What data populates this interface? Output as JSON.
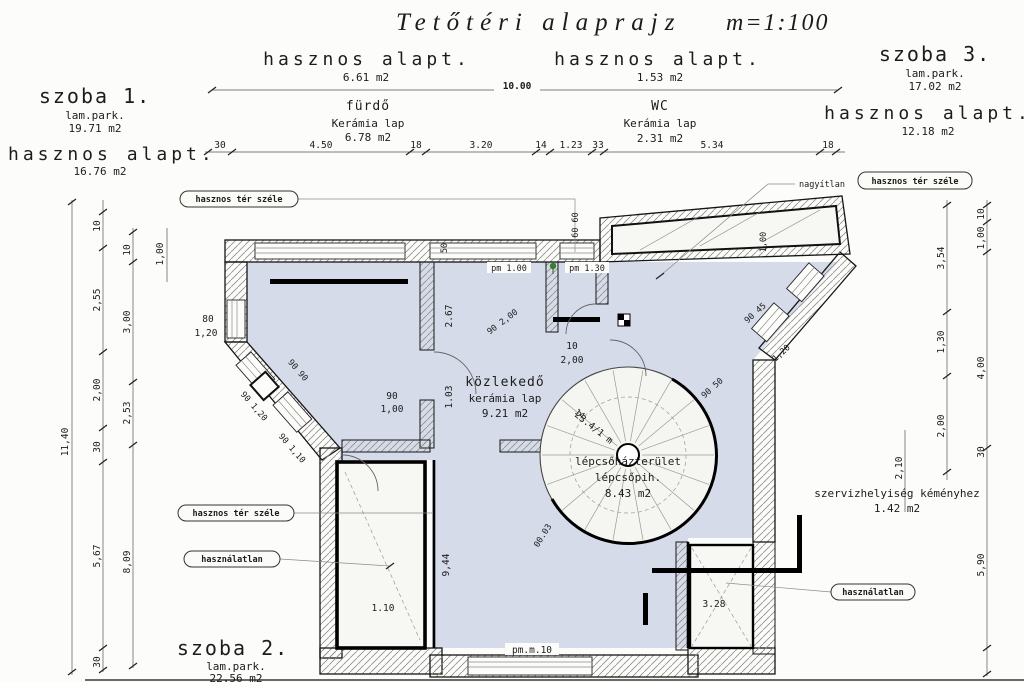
{
  "title": {
    "name": "Tetőtéri alaprajz",
    "scale": "m=1:100"
  },
  "rooms": {
    "szoba1": {
      "name": "szoba 1.",
      "floor": "lam.park.",
      "area": "19.71 m2",
      "useful": "hasznos alapt.",
      "useful_area": "16.76 m2"
    },
    "furdo": {
      "useful": "hasznos alapt.",
      "useful_area": "6.61 m2",
      "name": "fürdő",
      "floor": "Kerámia lap",
      "area": "6.78 m2"
    },
    "wc": {
      "useful": "hasznos alapt.",
      "useful_area": "1.53 m2",
      "name": "WC",
      "floor": "Kerámia lap",
      "area": "2.31 m2"
    },
    "szoba3": {
      "name": "szoba 3.",
      "floor": "lam.park.",
      "area": "17.02 m2",
      "useful": "hasznos alapt.",
      "useful_area": "12.18 m2"
    },
    "szoba2": {
      "name": "szoba 2.",
      "floor": "lam.park.",
      "area": "22.56 m2",
      "useful": "hasznos alapt."
    },
    "kozlekedo": {
      "name": "közlekedő",
      "floor": "kerámia lap",
      "area": "9.21 m2"
    },
    "lepcsohaz": {
      "name": "lépcsőházterület",
      "line2": "lépcsőpih.",
      "area": "8.43 m2"
    },
    "szerviz": {
      "name": "szervizhelyiség kéményhez",
      "area": "1.42 m2"
    }
  },
  "callouts": {
    "edge1": "hasznos tér széle",
    "edge2": "hasznos tér széle",
    "edge3": "hasznos tér széle",
    "unused1": "használatlan",
    "unused2": "használatlan",
    "prefix": "nagyítlan"
  },
  "dims": {
    "overall": "10.00",
    "top": [
      "30",
      "4.50",
      "18",
      "3.20",
      "14",
      "1.23",
      "33",
      "5.34",
      "18"
    ],
    "left": [
      "11,40",
      "10",
      "2,55",
      "2,00",
      "30",
      "5,67",
      "30",
      "10",
      "3,00",
      "2,53",
      "8,09",
      "1,00"
    ],
    "right": [
      "3,54",
      "1,30",
      "2,00",
      "2,10",
      "10",
      "1,00",
      "4,00",
      "30",
      "5,90"
    ],
    "plan": [
      "80",
      "1,20",
      "90 90",
      "90 1,20",
      "90 1,10",
      "90",
      "1,00",
      "2.67",
      "1.03",
      "50",
      "60 60",
      "10",
      "2,00",
      "90 2,00",
      "14",
      "23.4/1 m",
      "1,20",
      "90 45",
      "90 50",
      "1,00",
      "9,44",
      "00.03",
      "pm 1.00",
      "pm 1.30",
      "pm.m.10",
      "1.10",
      "3.28"
    ]
  }
}
